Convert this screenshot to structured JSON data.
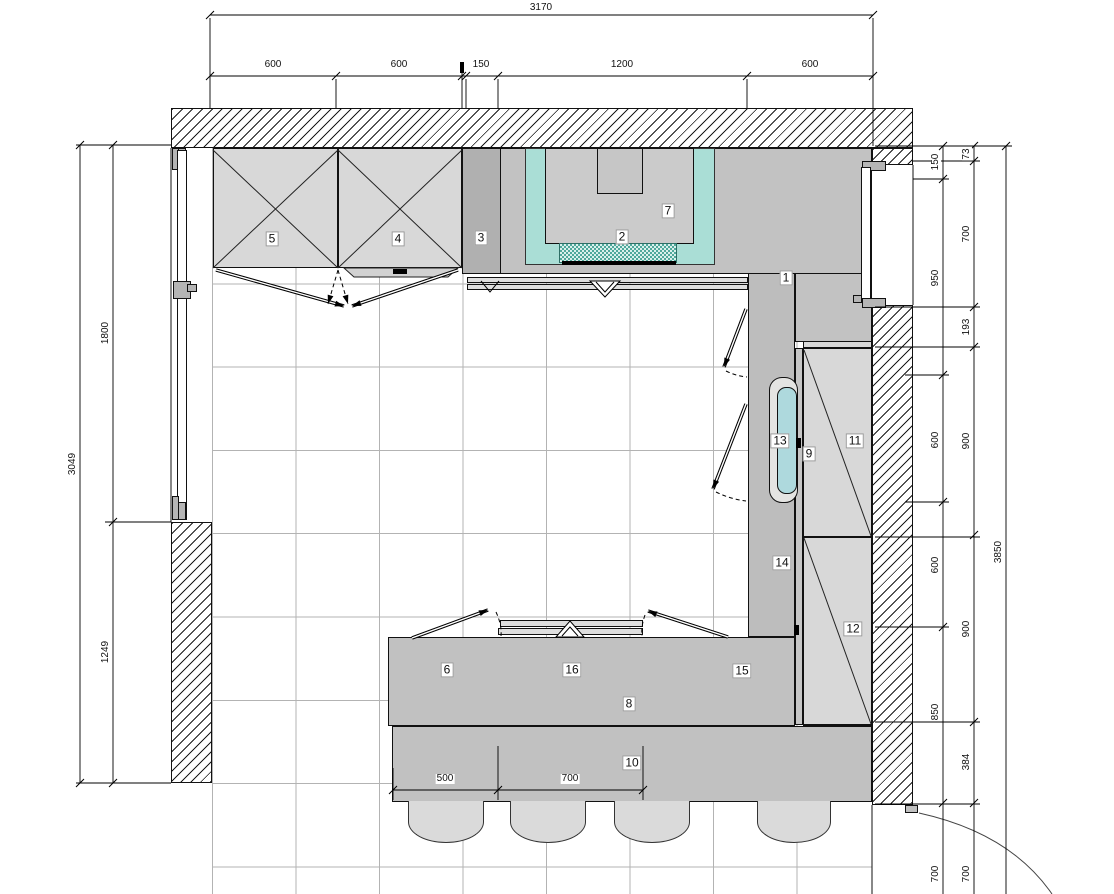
{
  "callouts": {
    "1": "1",
    "2": "2",
    "3": "3",
    "4": "4",
    "5": "5",
    "6": "6",
    "7": "7",
    "8": "8",
    "9": "9",
    "10": "10",
    "11": "11",
    "12": "12",
    "13": "13",
    "14": "14",
    "15": "15",
    "16": "16"
  },
  "dims": {
    "top_total": "3170",
    "top_segments": [
      "600",
      "600",
      "150",
      "1200",
      "600"
    ],
    "left_total": "3049",
    "left_segments": [
      "1800",
      "1249"
    ],
    "right_inner_segments": [
      "150",
      "950",
      "600",
      "600",
      "850",
      "700"
    ],
    "right_middle_segments": [
      "73",
      "700",
      "193",
      "900",
      "900",
      "384",
      "700"
    ],
    "right_total": "3850",
    "island_segments": [
      "500",
      "700"
    ]
  },
  "colors": {
    "counter_gray": "#c2c2c2",
    "counter_strip_gray": "#bdbdbd",
    "appliance_band_gray": "#b0b0b0",
    "cabinet_light_gray": "#d8d8d8",
    "teal_zone": "#aaded6",
    "checker_teal": "#4fa89b",
    "sink_basin_cyan": "#aed9dd",
    "stool_gray": "#dadada",
    "floor_grid_gray": "#b3b3b3",
    "hatch_line": "#1a1a1a"
  }
}
